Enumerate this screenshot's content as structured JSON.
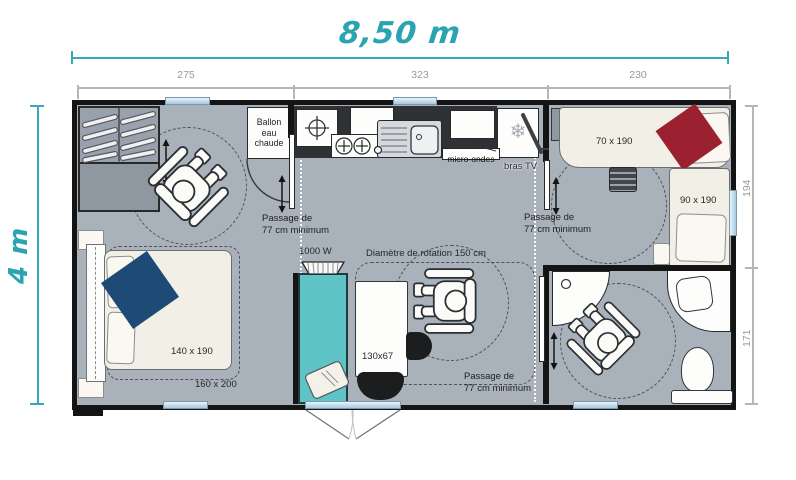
{
  "plan": {
    "overall": {
      "width_label": "8,50 m",
      "height_label": "4 m"
    },
    "dim_top_segments": [
      "275",
      "323",
      "230"
    ],
    "dim_right_segments": [
      "194",
      "171"
    ],
    "passage": {
      "line1": "Passage de",
      "line2": "77 cm minimum"
    },
    "rooms": {
      "water_heater": {
        "line1": "Ballon",
        "line2": "eau",
        "line3": "chaude"
      },
      "kitchen": {
        "microwave": "micro-ondes",
        "tv_arm": "bras TV"
      },
      "living": {
        "heater": "1000 W",
        "rotation": "Diamètre de rotation 150 cm",
        "table": "130x67"
      },
      "bedroom_master": {
        "bed": "140 x 190",
        "zone": "160 x 200"
      },
      "bedroom_2": {
        "bed_single": "70 x 190",
        "bed_large": "90 x 190"
      }
    },
    "icons": {
      "freezer_snowflake": "❄"
    },
    "colors": {
      "accent_teal": "#2ba4b2",
      "bench_teal": "#5ec4c6",
      "window_blue": "#bcd8ea",
      "floor_gray": "#a9b1ba",
      "bed_cream": "#f2efe6",
      "blanket_red": "#9c2130",
      "blanket_navy": "#1d4b76",
      "wall_black": "#141414"
    }
  }
}
